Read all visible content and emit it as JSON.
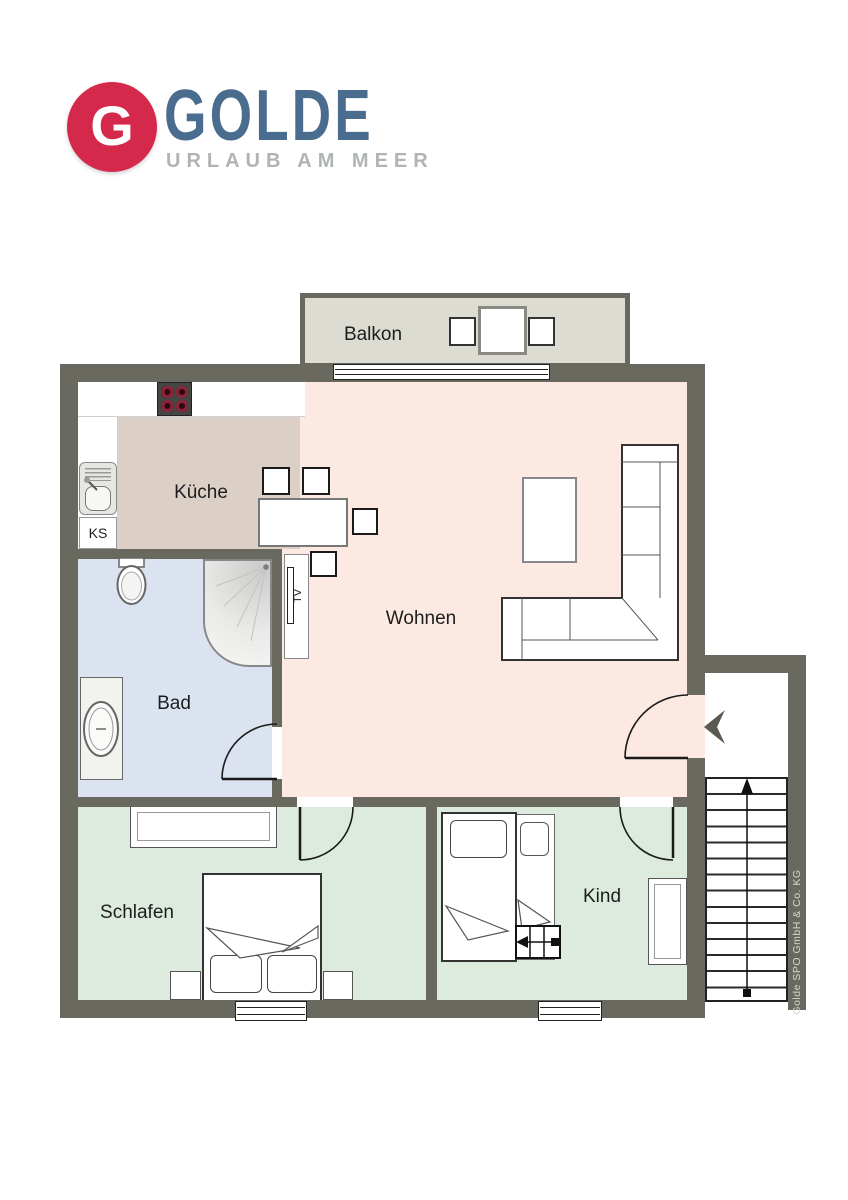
{
  "logo": {
    "initial": "G",
    "brand": "GOLDE",
    "tagline": "URLAUB AM MEER",
    "colors": {
      "badge": "#d5294b",
      "brand": "#4a6c8f",
      "tagline": "#b0b4b3"
    }
  },
  "floorplan": {
    "colors": {
      "wall": "#69695f",
      "balkon_floor": "#dcdcd2",
      "kueche_floor": "#dccfc6",
      "wohnen_floor": "#fceae2",
      "bad_floor": "#dce3f0",
      "schlafen_floor": "#ddeade",
      "kind_floor": "#ddeade"
    },
    "rooms": {
      "balkon": {
        "label": "Balkon"
      },
      "kueche": {
        "label": "Küche"
      },
      "wohnen": {
        "label": "Wohnen"
      },
      "bad": {
        "label": "Bad"
      },
      "schlafen": {
        "label": "Schlafen"
      },
      "kind": {
        "label": "Kind"
      }
    },
    "annotations": {
      "fridge": "KS",
      "tv": "TV"
    },
    "stairs_direction": "up",
    "credit": "Golde SPO GmbH & Co. KG"
  }
}
